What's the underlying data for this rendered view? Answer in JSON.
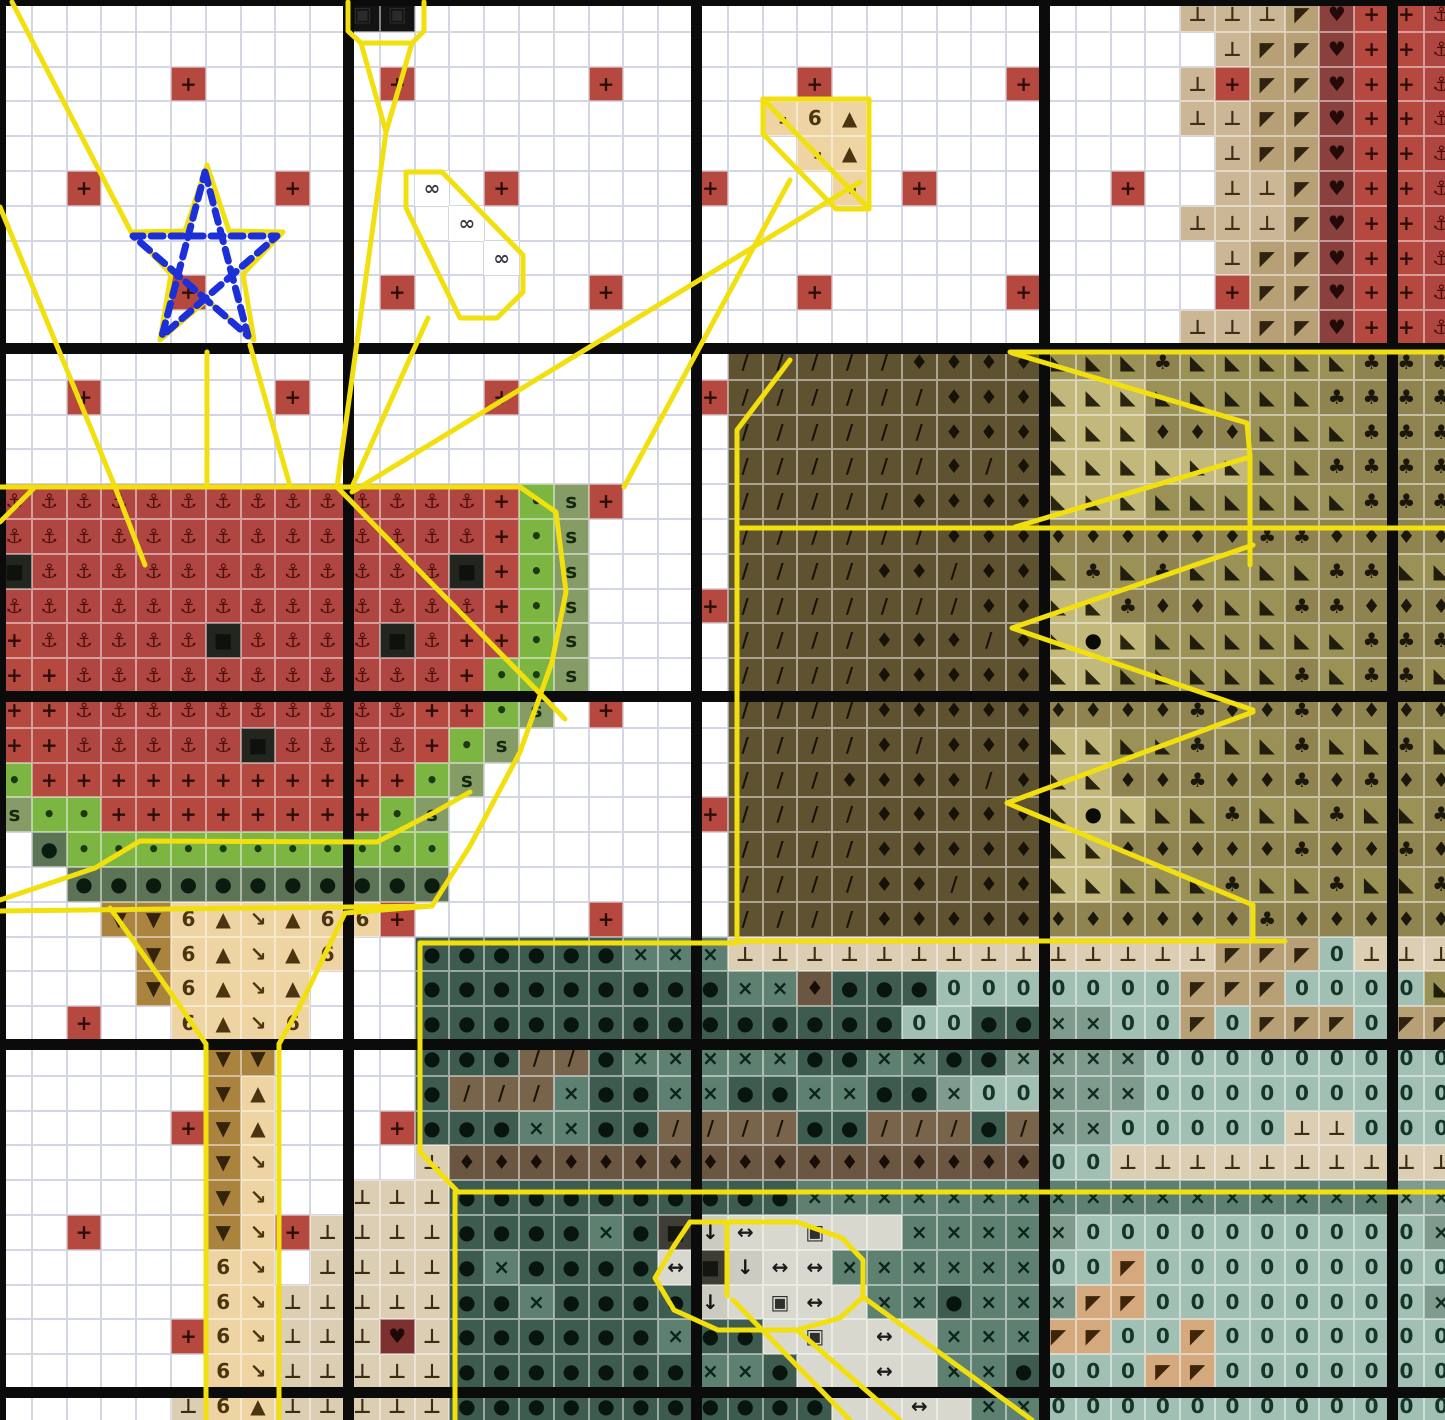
{
  "meta": {
    "kind": "cross-stitch pattern chart",
    "accent_backstitch": "#f2df0e",
    "motif_color": "#1c2fd8",
    "block_line_color": "#0b0b0b"
  },
  "grid": {
    "cols": 42,
    "rows": 41,
    "cell": 34.8,
    "origin": -3,
    "rows_data": [
      "..........##......................tttfmRRA",
      "...................................tffmRRA",
      ".....R.....R.....R.....R.....R....tRffmRRA",
      "......................\\64.........ttffmRRA",
      ".......................\\4..........tffmRRA",
      "..R.....R...8.R.....R...\\.R.....R..ttfmRRA",
      ".............8....................tttfmRRA",
      "..............8....................tffmRRA",
      ".....R.....R.....R.....R.....R.....RffmRRA",
      "..................................ttffmRRA",
      ".....................OOOOOQQQQcccpcccccppp",
      "..R.....R.....R.....ROOOOOOQQQWWWcccccpppp",
      ".....................OOOOOOQQQWWWqqqcccppp",
      ".....................OOOOOOQOQWWWWWWccpppp",
      "AAAAAAAAAAAAAARGSR...OOOOOQQQQWWWccccccppp",
      "AAAAAAAAAAAAAARGS....OOOOOOQQQqqqqqqppqqqq",
      "KAAAAAAAAAAAAKRGS....OOOOQQOQQcpcpccccppcc",
      "AAAAAAAAAAAAAARGS...ROOOOOOOQQWWpqqccppqqq",
      "RAAAAAKAAAAKARRGS....OOOOQQQOQWeWccccccppp",
      "RRAAAAAAAAAAARGGS....OOOOQQQQQWWcccccpcppc",
      "RRAAAAAAAAAARRGS.R...OOOOQQQQQqqqqpqqpqqqq",
      "RRAAAAAKAAAARGS......OOOOQOQQQWWccpccpccpc",
      "GRRRRRRRRRRRGS.......OOOQQQQOQWWqqpqqpqpqq",
      "SGGRRRRRRRRGS.......ROOOOQQQQQWeWccpccpccp",
      ".DGGGGGGGGGGG........OOOOQQQQQWWqqqqqpqqpq",
      "..DDDDDDDDDDD........OOOOQQOQQWWcccpccpccp",
      "...VV64\\466R.....R...OOOOQQQQQqqqqqqpqqqqq",
      "....V64\\46..YYYYYYXXXLLLLLLLLLLLLLLfff0LLL",
      "....V64\\4...YYYYYYYYYXXdYYY0000000fff0000c",
      "..R..64\\6...YYYYYYYYYYYYYY00YYxx00f0fff0ff",
      "......VV....YYYZZYXXXXXYYXXYYxxxx000000000",
      "......V4....YZZZXYYXXYYXXYYx00xxx000000000",
      ".....RV4...RYYYXXYYZZZZYYZZZYZxx00000LL000",
      "......V\\....Lddddddddddddddddd00LLLLLLLLLL",
      "......V\\..LLLYYYYYYYYYYXXXXXXXXXXXXXXXXXxx",
      "..R...V\\RLLLLYYYYXYBvunwnnXXXXx0000000000x",
      "......6\\.LLLLYXYYYYuBvuuXXXXXX00k000000000",
      "......6\\LLLLLYYXYYYYvnwunXXYXXxkk00000000x",
      ".....R6\\LLLHLYYYYYYXYYnwnunXXXkk00k0000000",
      "......6\\LLLLLYYYYYYYXXYnnunXXY000kk0000000",
      ".....L64LLLLLYYYYYYYYYYYnnunXX000000000000"
    ]
  },
  "palette": {
    ".": {
      "bg": "#ffffff",
      "sym": "",
      "fg": "#000000",
      "name": "empty"
    },
    "R": {
      "bg": "#b5483f",
      "sym": "+",
      "fg": "#2e0d09",
      "name": "red-cross"
    },
    "A": {
      "bg": "#b04641",
      "sym": "⚓",
      "fg": "#4f100c",
      "name": "red-anchor"
    },
    "K": {
      "bg": "#23261f",
      "sym": "■",
      "fg": "#0e120c",
      "name": "black-seed"
    },
    "G": {
      "bg": "#7cb542",
      "sym": "•",
      "fg": "#1c3a12",
      "name": "green-dot"
    },
    "S": {
      "bg": "#859c66",
      "sym": "s",
      "fg": "#14280e",
      "name": "sage-s"
    },
    "D": {
      "bg": "#5c7356",
      "sym": "●",
      "fg": "#0b1b10",
      "name": "darkgreen-dot"
    },
    "6": {
      "bg": "#eed4a2",
      "sym": "6",
      "fg": "#4b3410",
      "name": "tan-six"
    },
    "4": {
      "bg": "#eed4a2",
      "sym": "▲",
      "fg": "#4b3410",
      "name": "tan-triangle"
    },
    "\\": {
      "bg": "#eed4a2",
      "sym": "↘",
      "fg": "#4b3410",
      "name": "tan-bone"
    },
    "V": {
      "bg": "#aa833f",
      "sym": "▼",
      "fg": "#33230a",
      "name": "brown-down-triangle"
    },
    "L": {
      "bg": "#dbceb3",
      "sym": "⊥",
      "fg": "#3c2c16",
      "name": "pale-tack"
    },
    "H": {
      "bg": "#7c3130",
      "sym": "♥",
      "fg": "#1e0706",
      "name": "maroon-heart"
    },
    "t": {
      "bg": "#cbb795",
      "sym": "⊥",
      "fg": "#3e2e1a",
      "name": "band-tack"
    },
    "f": {
      "bg": "#b7a076",
      "sym": "◤",
      "fg": "#2f2210",
      "name": "band-flag"
    },
    "m": {
      "bg": "#8a403c",
      "sym": "♥",
      "fg": "#240a08",
      "name": "band-heart"
    },
    "O": {
      "bg": "#5f5231",
      "sym": "/",
      "fg": "#171208",
      "name": "brown-slash"
    },
    "Q": {
      "bg": "#5f5231",
      "sym": "♦",
      "fg": "#171208",
      "name": "brown-diamond"
    },
    "q": {
      "bg": "#8f8450",
      "sym": "♦",
      "fg": "#1b170b",
      "name": "khaki-diamond"
    },
    "c": {
      "bg": "#9a9157",
      "sym": "◣",
      "fg": "#211d0e",
      "name": "khaki-corner"
    },
    "p": {
      "bg": "#8f8450",
      "sym": "♣",
      "fg": "#1b170b",
      "name": "khaki-club"
    },
    "W": {
      "bg": "#c3b87c",
      "sym": "◣",
      "fg": "#2a250f",
      "name": "light-khaki-corner"
    },
    "e": {
      "bg": "#c3b87c",
      "sym": "●",
      "fg": "#0a0a06",
      "name": "french-knot"
    },
    "Y": {
      "bg": "#3d5b4e",
      "sym": "●",
      "fg": "#07150e",
      "name": "teal-dot"
    },
    "X": {
      "bg": "#5e8071",
      "sym": "×",
      "fg": "#0c231a",
      "name": "teal-x"
    },
    "x": {
      "bg": "#7f9b8d",
      "sym": "×",
      "fg": "#12291f",
      "name": "gray-teal-x"
    },
    "0": {
      "bg": "#a2bfb3",
      "sym": "0",
      "fg": "#153529",
      "name": "blue-zero"
    },
    "Z": {
      "bg": "#77644b",
      "sym": "/",
      "fg": "#1b130a",
      "name": "umber-slash"
    },
    "d": {
      "bg": "#6b5741",
      "sym": "♦",
      "fg": "#170e07",
      "name": "umber-diamond"
    },
    "n": {
      "bg": "#d8d8ce",
      "sym": "",
      "fg": "#1c1c1c",
      "name": "gray-blank"
    },
    "u": {
      "bg": "#d8d8ce",
      "sym": "↔",
      "fg": "#1c1c1c",
      "name": "gray-arrows"
    },
    "v": {
      "bg": "#cbcbc1",
      "sym": "↓",
      "fg": "#141414",
      "name": "gray-down-arrow"
    },
    "w": {
      "bg": "#d8d8ce",
      "sym": "▣",
      "fg": "#2e2e2e",
      "name": "gray-square"
    },
    "B": {
      "bg": "#3d3d35",
      "sym": "■",
      "fg": "#141410",
      "name": "dark-square"
    },
    "8": {
      "bg": "#ffffff",
      "sym": "∞",
      "fg": "#3c3c44",
      "name": "white-infinity"
    },
    "#": {
      "bg": "#131313",
      "sym": "▣",
      "fg": "#2b2b2b",
      "name": "black-block"
    },
    "k": {
      "bg": "#d4a97d",
      "sym": "◤",
      "fg": "#3e250a",
      "name": "tan-flag"
    }
  },
  "block_lines": {
    "xs": [
      -5,
      343,
      691,
      1039,
      1387
    ],
    "ys": [
      -5,
      343,
      691,
      1039,
      1387
    ],
    "width": 11
  },
  "backstitch": {
    "color": "#f2df0e",
    "width": 5,
    "paths": [
      [
        [
          0,
          487
        ],
        [
          520,
          487
        ]
      ],
      [
        [
          0,
          522
        ],
        [
          35,
          487
        ]
      ],
      [
        [
          520,
          487
        ],
        [
          556,
          512
        ],
        [
          566,
          592
        ],
        [
          552,
          662
        ],
        [
          520,
          752
        ],
        [
          470,
          846
        ],
        [
          432,
          906
        ],
        [
          345,
          913
        ]
      ],
      [
        [
          0,
          911
        ],
        [
          432,
          906
        ]
      ],
      [
        [
          0,
          900
        ],
        [
          95,
          868
        ],
        [
          140,
          841
        ],
        [
          377,
          842
        ],
        [
          435,
          812
        ],
        [
          470,
          792
        ]
      ],
      [
        [
          110,
          908
        ],
        [
          180,
          1006
        ],
        [
          206,
          1044
        ]
      ],
      [
        [
          345,
          913
        ],
        [
          300,
          1006
        ],
        [
          279,
          1044
        ]
      ],
      [
        [
          206,
          1044
        ],
        [
          206,
          1420
        ]
      ],
      [
        [
          279,
          1044
        ],
        [
          279,
          1420
        ]
      ],
      [
        [
          348,
          2
        ],
        [
          348,
          31
        ],
        [
          361,
          43
        ],
        [
          412,
          43
        ],
        [
          424,
          31
        ],
        [
          424,
          2
        ]
      ],
      [
        [
          361,
          43
        ],
        [
          386,
          132
        ],
        [
          412,
          43
        ]
      ],
      [
        [
          386,
          132
        ],
        [
          337,
          487
        ]
      ],
      [
        [
          337,
          487
        ],
        [
          565,
          719
        ]
      ],
      [
        [
          115,
          487
        ],
        [
          145,
          565
        ]
      ],
      [
        [
          207,
          165
        ],
        [
          229,
          231
        ],
        [
          283,
          232
        ],
        [
          243,
          274
        ],
        [
          254,
          340
        ],
        [
          207,
          300
        ],
        [
          160,
          340
        ],
        [
          171,
          274
        ],
        [
          131,
          232
        ],
        [
          185,
          231
        ],
        [
          207,
          165
        ]
      ],
      [
        [
          131,
          232
        ],
        [
          12,
          2
        ]
      ],
      [
        [
          207,
          352
        ],
        [
          207,
          486
        ]
      ],
      [
        [
          250,
          345
        ],
        [
          290,
          486
        ]
      ],
      [
        [
          0,
          207
        ],
        [
          115,
          487
        ]
      ],
      [
        [
          406,
          172
        ],
        [
          442,
          172
        ],
        [
          523,
          255
        ],
        [
          523,
          292
        ],
        [
          497,
          318
        ],
        [
          460,
          318
        ],
        [
          406,
          208
        ],
        [
          406,
          172
        ]
      ],
      [
        [
          428,
          318
        ],
        [
          352,
          487
        ]
      ],
      [
        [
          763,
          99
        ],
        [
          869,
          99
        ],
        [
          869,
          209
        ],
        [
          836,
          209
        ],
        [
          763,
          134
        ],
        [
          763,
          99
        ]
      ],
      [
        [
          763,
          99
        ],
        [
          869,
          209
        ]
      ],
      [
        [
          790,
          180
        ],
        [
          624,
          487
        ]
      ],
      [
        [
          860,
          182
        ],
        [
          352,
          492
        ]
      ],
      [
        [
          1010,
          352
        ],
        [
          1445,
          352
        ]
      ],
      [
        [
          737,
          528
        ],
        [
          1445,
          528
        ]
      ],
      [
        [
          790,
          360
        ],
        [
          737,
          430
        ],
        [
          737,
          941
        ]
      ],
      [
        [
          1012,
          353
        ],
        [
          1247,
          423
        ],
        [
          1250,
          457
        ],
        [
          1015,
          527
        ]
      ],
      [
        [
          1250,
          457
        ],
        [
          1250,
          565
        ]
      ],
      [
        [
          1253,
          545
        ],
        [
          1012,
          628
        ],
        [
          1253,
          710
        ]
      ],
      [
        [
          1253,
          712
        ],
        [
          1007,
          803
        ],
        [
          1253,
          905
        ]
      ],
      [
        [
          1253,
          905
        ],
        [
          1253,
          941
        ]
      ],
      [
        [
          737,
          941
        ],
        [
          1285,
          941
        ]
      ],
      [
        [
          420,
          943
        ],
        [
          737,
          943
        ]
      ],
      [
        [
          420,
          943
        ],
        [
          420,
          1152
        ],
        [
          458,
          1192
        ]
      ],
      [
        [
          458,
          1192
        ],
        [
          1445,
          1192
        ]
      ],
      [
        [
          455,
          1192
        ],
        [
          455,
          1420
        ]
      ],
      [
        [
          690,
          1222
        ],
        [
          797,
          1222
        ],
        [
          842,
          1238
        ],
        [
          863,
          1260
        ],
        [
          863,
          1297
        ],
        [
          840,
          1318
        ],
        [
          797,
          1330
        ],
        [
          718,
          1330
        ],
        [
          674,
          1310
        ],
        [
          655,
          1278
        ],
        [
          674,
          1246
        ],
        [
          690,
          1222
        ]
      ],
      [
        [
          727,
          1224
        ],
        [
          727,
          1296
        ]
      ],
      [
        [
          733,
          1300
        ],
        [
          850,
          1420
        ]
      ],
      [
        [
          863,
          1297
        ],
        [
          1032,
          1420
        ]
      ],
      [
        [
          797,
          1330
        ],
        [
          900,
          1420
        ]
      ]
    ]
  },
  "motif_star": {
    "color": "#1c2fd8",
    "width": 7,
    "dash": "12 8",
    "path": [
      [
        205,
        172
      ],
      [
        248,
        336
      ],
      [
        133,
        236
      ],
      [
        277,
        236
      ],
      [
        162,
        336
      ],
      [
        205,
        172
      ]
    ]
  }
}
